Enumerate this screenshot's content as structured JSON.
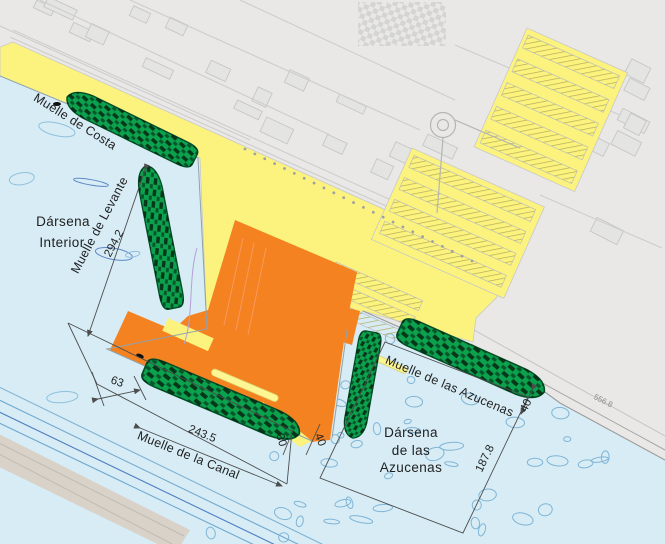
{
  "map": {
    "basins": [
      {
        "id": "darsena-interior",
        "name_lines": [
          "Dársena",
          "Interior"
        ]
      },
      {
        "id": "darsena-de-las-azucenas",
        "name_lines": [
          "Dársena",
          "de las",
          "Azucenas"
        ]
      }
    ],
    "quays": [
      {
        "id": "muelle-de-costa",
        "name": "Muelle de Costa",
        "length": ""
      },
      {
        "id": "muelle-de-levante",
        "name": "Muelle de Levante",
        "length": "294.2"
      },
      {
        "id": "muelle-de-la-canal",
        "name": "Muelle de la Canal",
        "length": "243.5"
      },
      {
        "id": "muelle-de-las-azucenas",
        "name": "Muelle de las Azucenas",
        "length": "187.8"
      }
    ],
    "measurements": {
      "quay_offset": "63",
      "canal_quay_width": "30",
      "canal_gap": "40",
      "azucenas_quay_width": "40",
      "access_road": "556.8"
    },
    "colors": {
      "city_background": "#e9e8e7",
      "water": "#d7ecf5",
      "port_land": "#fbf37d",
      "terminal": "#f58220",
      "ship": "#0ba14d",
      "contour_line": "#8fc0dc",
      "breakwater": "#d8d2c9",
      "dimension_line": "#4d4d4d"
    }
  }
}
